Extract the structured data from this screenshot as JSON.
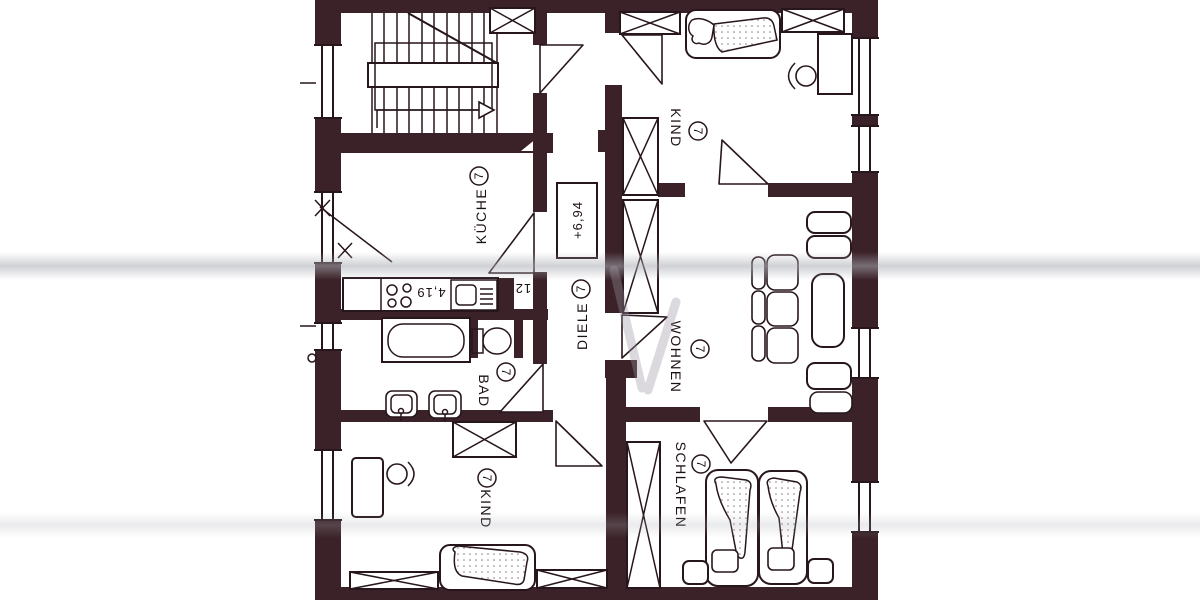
{
  "plan": {
    "rooms": [
      {
        "label": "KÜCHE",
        "unit": "7"
      },
      {
        "label": "DIELE",
        "unit": "7"
      },
      {
        "label": "WOHNEN",
        "unit": "7"
      },
      {
        "label": "BAD",
        "unit": "7"
      },
      {
        "label": "KIND",
        "unit": "7"
      },
      {
        "label": "KIND",
        "unit": "7"
      },
      {
        "label": "SCHLAFEN",
        "unit": "7"
      }
    ],
    "annotations": {
      "level_marker": "+6,94",
      "kitchen_dimension": "4,19",
      "shaft_number": "12"
    },
    "colors": {
      "wall": "#3b2228",
      "line": "#27161c",
      "paper": "#ffffff",
      "glare": "#aaacb4"
    }
  }
}
